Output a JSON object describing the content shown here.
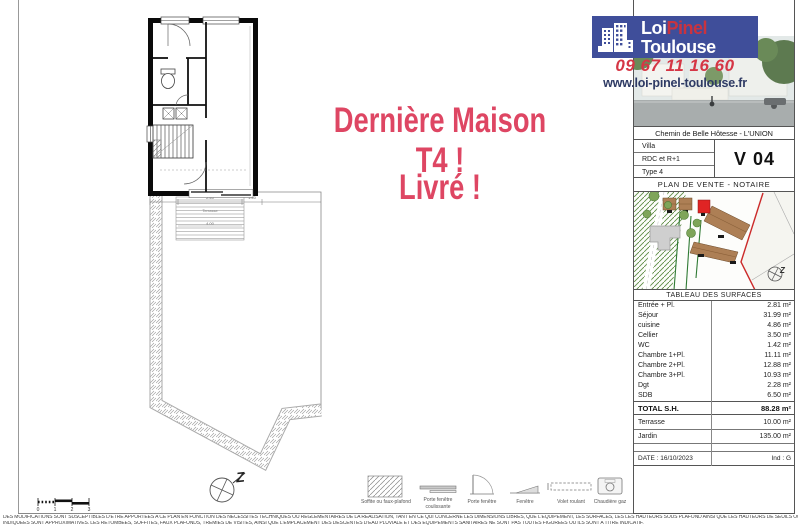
{
  "brand": {
    "name_part1": "Loi",
    "name_part2": "Pinel",
    "name_line2": "Toulouse",
    "phone": "09 67 11 16 60",
    "website": "www.loi-pinel-toulouse.fr"
  },
  "promo": {
    "line1": "Dernière Maison T4 !",
    "line2": "Livré !"
  },
  "plan": {
    "rooms": {
      "entree": "Entrée",
      "wc": "WC",
      "cellier": "Cellier",
      "cuisine": "Cuisine",
      "sejour": "Séjour",
      "terrasse": "Terrasse"
    },
    "dims": {
      "d1": "2.40",
      "d2": "1.40",
      "d3": "4.00",
      "d4": "5.96"
    },
    "north": "Z",
    "scale_ticks": [
      "0",
      "1",
      "2",
      "3"
    ]
  },
  "sidebar": {
    "address": "Chemin de Belle Hôtesse - L'UNION",
    "unit_rows": [
      "Villa",
      "RDC et R+1",
      "Type 4"
    ],
    "unit_code": "V 04",
    "doc_title": "PLAN DE VENTE - NOTAIRE",
    "map_north": "Z",
    "surfaces": {
      "title": "TABLEAU DES SURFACES",
      "rows": [
        {
          "label": "Entrée + Pl.",
          "value": "2.81 m²"
        },
        {
          "label": "Séjour",
          "value": "31.99 m²"
        },
        {
          "label": "cuisine",
          "value": "4.86 m²"
        },
        {
          "label": "Cellier",
          "value": "3.50 m²"
        },
        {
          "label": "WC",
          "value": "1.42 m²"
        },
        {
          "label": "Chambre 1+Pl.",
          "value": "11.11 m²"
        },
        {
          "label": "Chambre 2+Pl.",
          "value": "12.88 m²"
        },
        {
          "label": "Chambre 3+Pl.",
          "value": "10.93 m²"
        },
        {
          "label": "Dgt",
          "value": "2.28 m²"
        },
        {
          "label": "SDB",
          "value": "6.50 m²"
        }
      ],
      "total_label": "TOTAL S.H.",
      "total_value": "88.28 m²",
      "terrasse_label": "Terrasse",
      "terrasse_value": "10.00 m²",
      "jardin_label": "Jardin",
      "jardin_value": "135.00 m²",
      "date": "DATE : 16/10/2023",
      "index": "Ind : G"
    }
  },
  "legend": {
    "items": [
      "Soffite ou faux-plafond",
      "Porte fenêtre coulissante",
      "Porte fenêtre",
      "Fenêtre",
      "Volet roulant",
      "Chaudière gaz"
    ]
  },
  "footer": {
    "line1": "DES MODIFICATIONS SONT SUSCEPTIBLES D'ETRE APPORTEES A CE PLAN EN FONCTION DES NECESSITES TECHNIQUES OU REGLEMENTAIRES DE LA REALISATION, TANT EN CE QUI CONCERNE LES DIMENSIONS LIBRES, QUE L'EQUIPEMENT, LES SURFACES, LES LES HAUTEURS SOUS PLAFOND AINSI QUE LES HAUTEURS DE SEUILS OU D'ALLEGES",
    "line2": "INDIQUEES SONT APPROXIMATIVES. LES RETOMBEES, SOFFITES, FAUX PLAFONDS, TREMIES DE VISITES, AINSI QUE L'EMPLACEMENT DES DESCENTES D'EAU PLUVIALE ET DES EQUIPEMENTS SANITAIRES NE SONT PAS TOUTES FIGUREES OU ILS SONT A TITRE INDICATIF."
  },
  "colors": {
    "logo_bg": "#3f4e9a",
    "accent_red": "#d53645",
    "navy": "#2e3a64",
    "promo_pink": "#de4663",
    "map_unit_red": "#e02424"
  }
}
